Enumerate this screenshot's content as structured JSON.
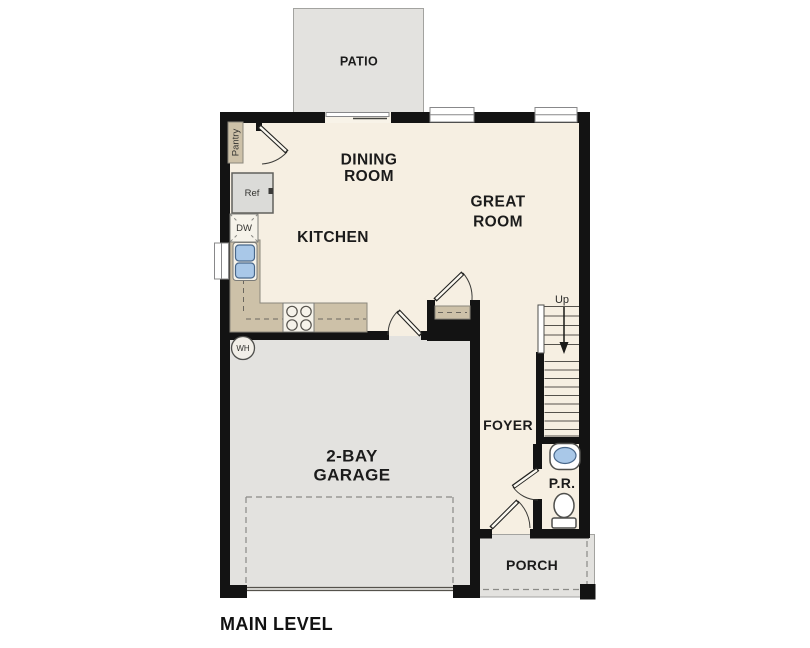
{
  "floor_plan": {
    "level_title": "MAIN LEVEL",
    "rooms": {
      "patio": {
        "label": "PATIO"
      },
      "dining_room": {
        "label_line1": "DINING",
        "label_line2": "ROOM"
      },
      "great_room": {
        "label_line1": "GREAT",
        "label_line2": "ROOM"
      },
      "kitchen": {
        "label": "KITCHEN"
      },
      "garage": {
        "label_line1": "2-BAY",
        "label_line2": "GARAGE"
      },
      "foyer": {
        "label": "FOYER"
      },
      "powder_room": {
        "label": "P.R."
      },
      "porch": {
        "label": "PORCH"
      },
      "pantry": {
        "label": "Pantry"
      }
    },
    "fixtures": {
      "refrigerator": {
        "label": "Ref"
      },
      "dishwasher": {
        "label": "DW"
      },
      "water_heater": {
        "label": "WH"
      },
      "stairs": {
        "direction_label": "Up"
      }
    },
    "colors": {
      "wall": "#131313",
      "floor": "#f6efe2",
      "outdoor_concrete": "#e3e2df",
      "counter_tan": "#cdc1a8",
      "sink_blue": "#a9c8e8",
      "window_white": "#ffffff"
    }
  }
}
